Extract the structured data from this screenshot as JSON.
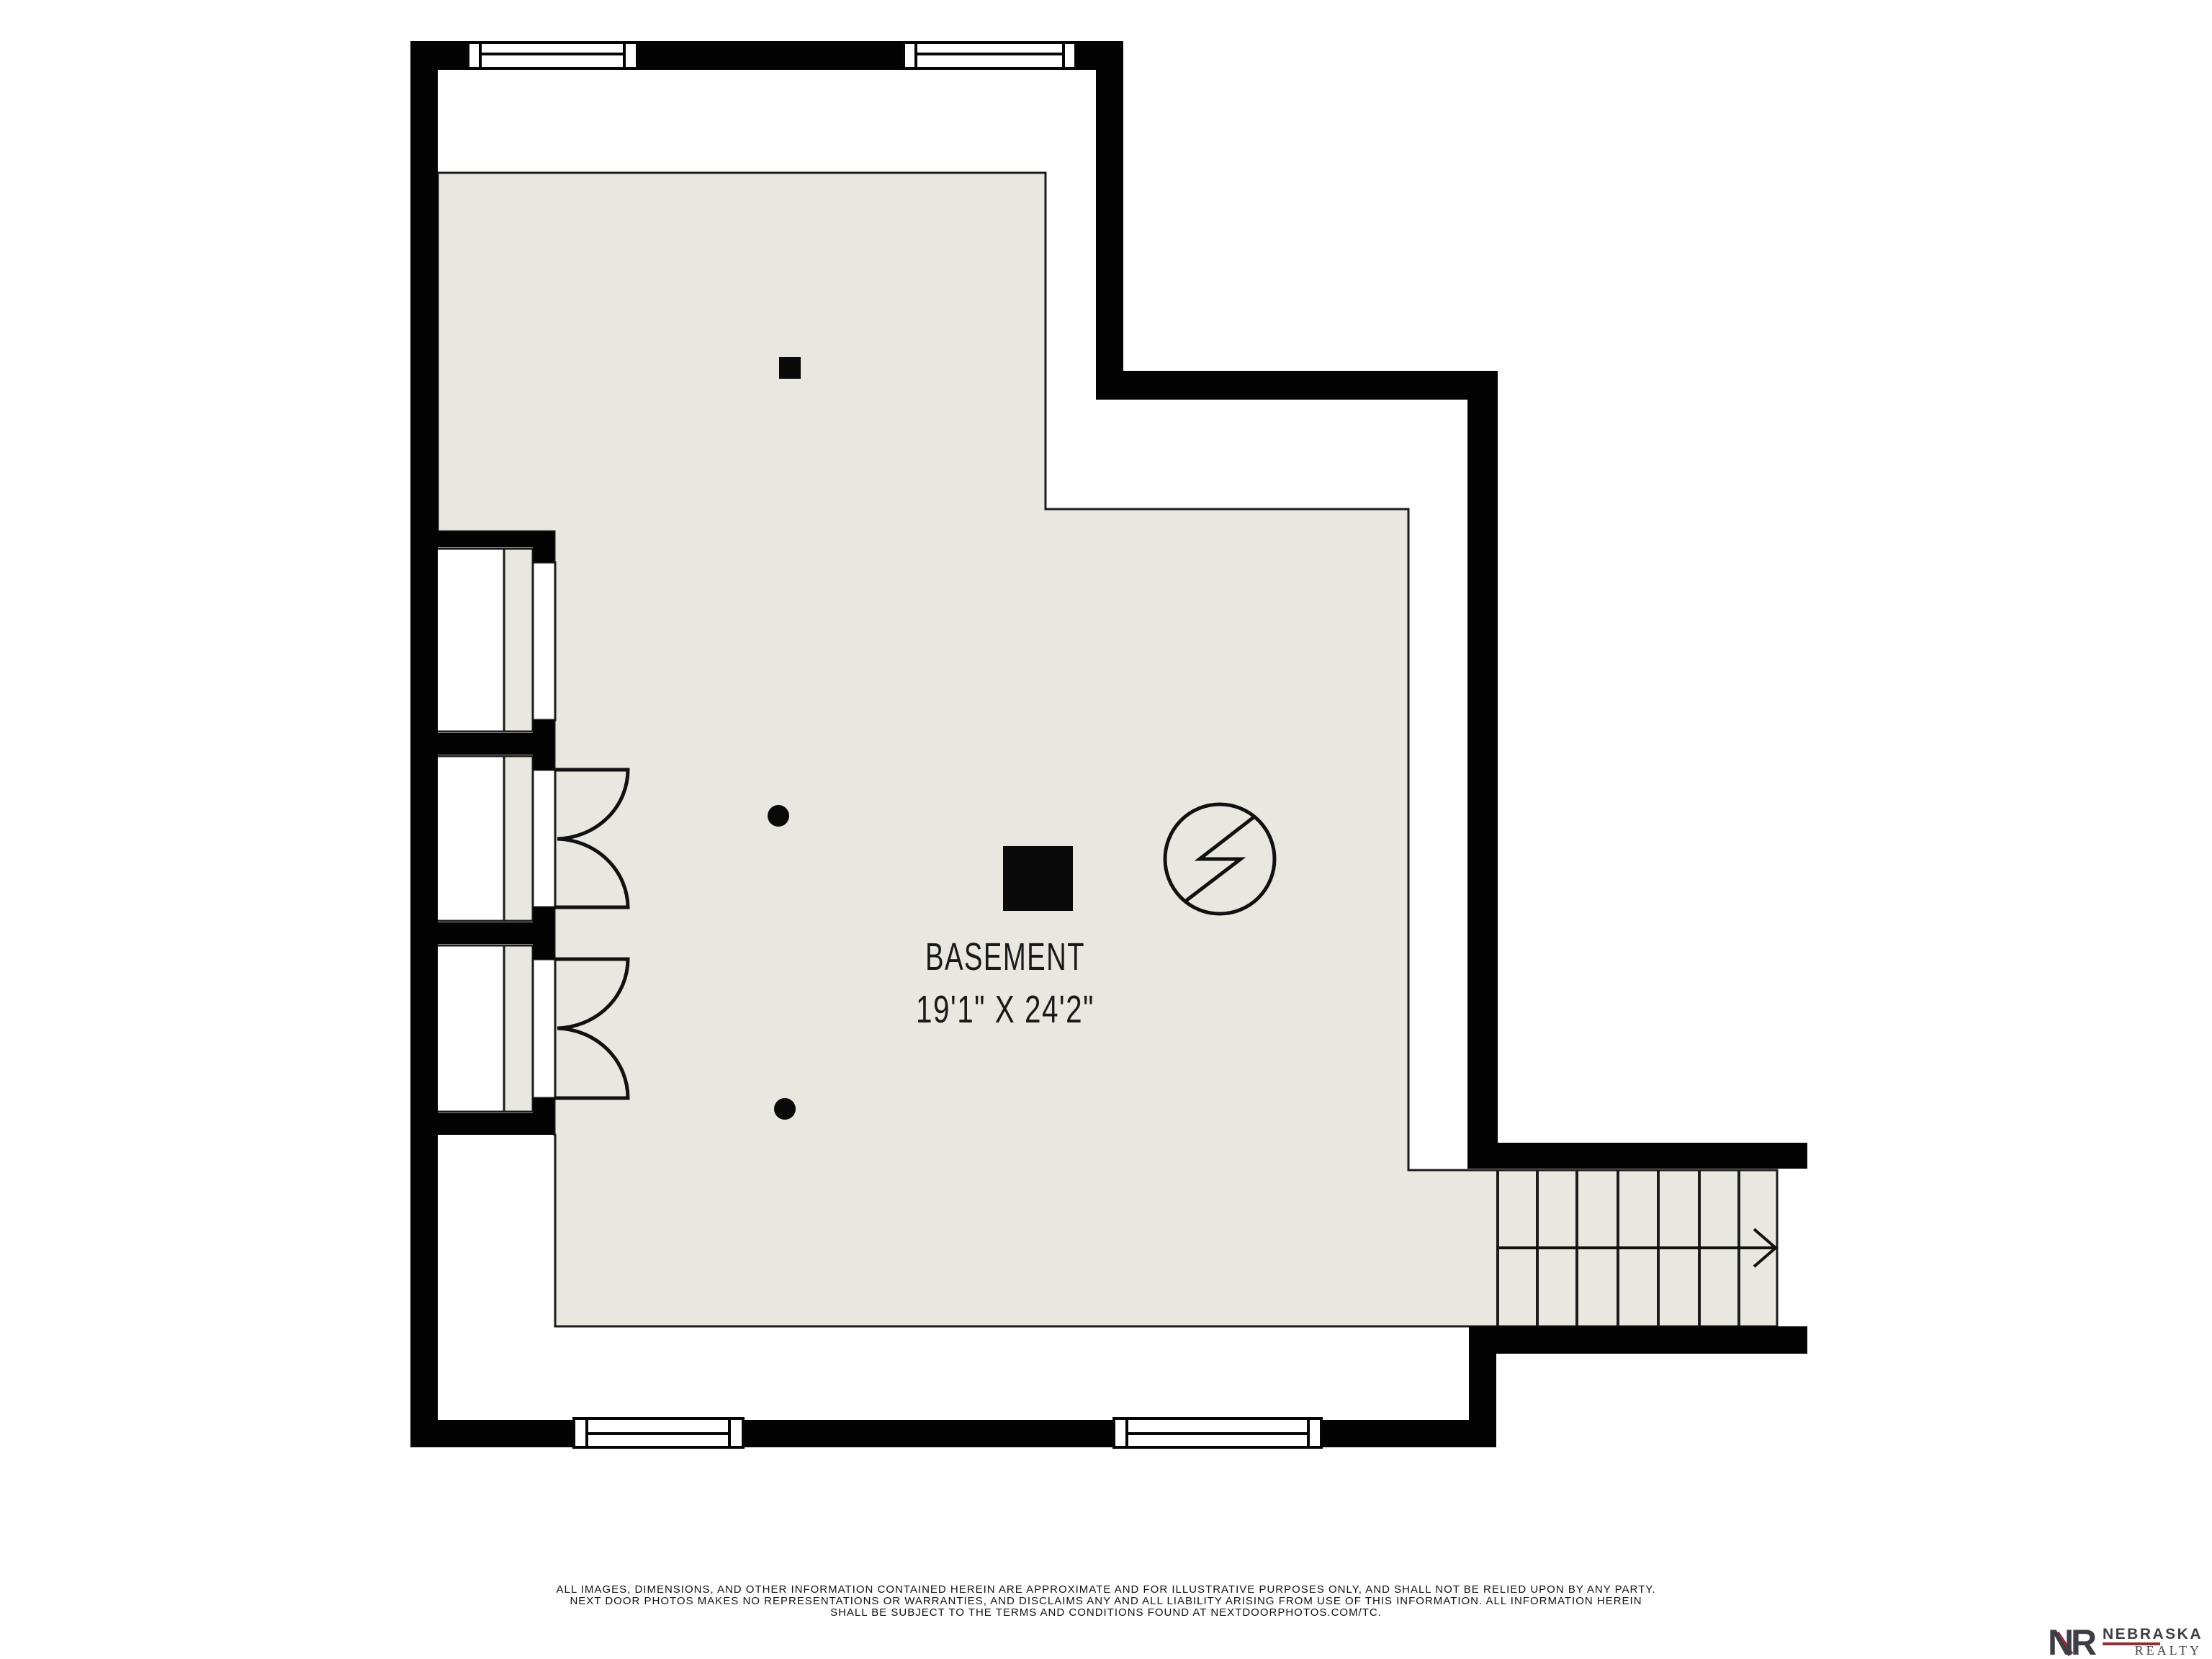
{
  "room": {
    "label": "BASEMENT",
    "dimensions": "19'1\" X 24'2\""
  },
  "footer": {
    "line1": "ALL IMAGES, DIMENSIONS, AND OTHER INFORMATION CONTAINED HEREIN ARE APPROXIMATE AND FOR ILLUSTRATIVE PURPOSES ONLY, AND SHALL NOT BE RELIED UPON BY ANY PARTY.",
    "line2": "NEXT DOOR PHOTOS MAKES NO REPRESENTATIONS OR WARRANTIES, AND DISCLAIMS ANY AND ALL LIABILITY ARISING FROM USE OF THIS INFORMATION. ALL INFORMATION HEREIN",
    "line3": "SHALL BE SUBJECT TO THE TERMS AND CONDITIONS FOUND AT NEXTDOORPHOTOS.COM/TC."
  },
  "logo": {
    "monogram_n": "N",
    "monogram_r": "R",
    "name": "NEBRASKA",
    "subname": "REALTY"
  },
  "symbols": {
    "electrical": "circle-lightning-icon",
    "stair_direction": "arrow-right-icon",
    "supports": "support-post-dots",
    "furnace": "solid-black-square"
  },
  "colors": {
    "floor": "#e8e8e0",
    "wall": "#030303",
    "line": "#1c1c1c",
    "background": "#ffffff",
    "logo_dark": "#3e3e46",
    "logo_red": "#9c2b31"
  }
}
